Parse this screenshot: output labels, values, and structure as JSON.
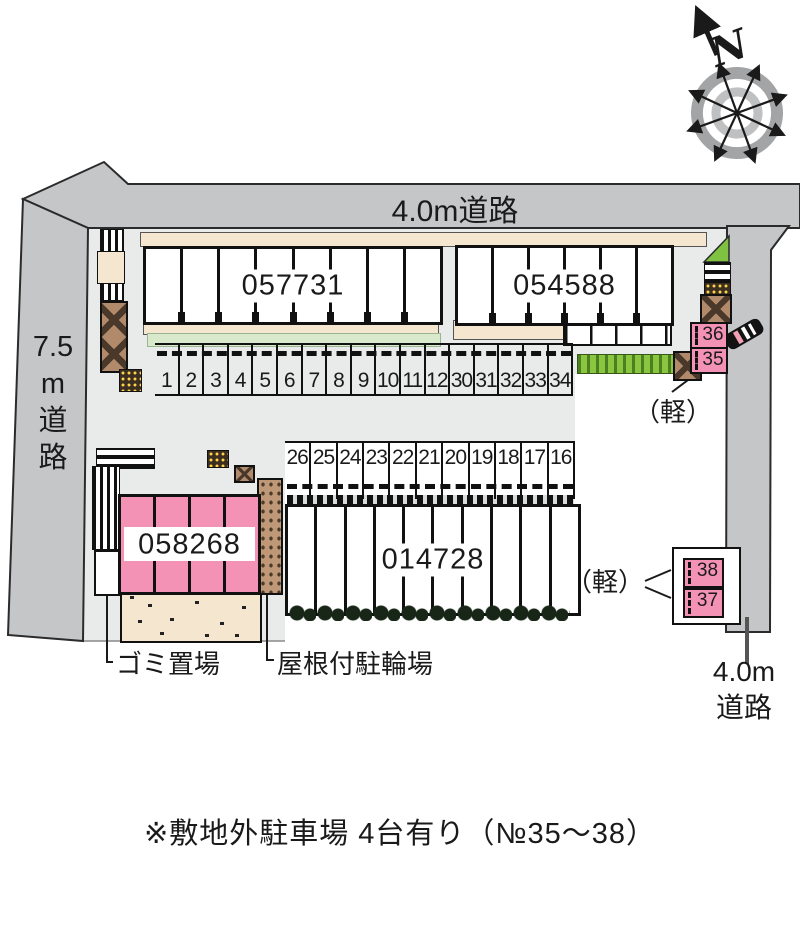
{
  "roads": {
    "top": {
      "label": "4.0m道路"
    },
    "left": {
      "lines": [
        "7.5",
        "m",
        "道",
        "路"
      ]
    },
    "right": {
      "lines": [
        "4.0m",
        "道路"
      ]
    }
  },
  "compass": {
    "north_label": "N"
  },
  "buildings": {
    "b1": {
      "id": "057731",
      "units": 8
    },
    "b2": {
      "id": "054588",
      "units": 6
    },
    "b3": {
      "id": "058268",
      "units": 4
    },
    "b4": {
      "id": "014728",
      "units": 10
    }
  },
  "parking": {
    "row1": [
      "1",
      "2",
      "3",
      "4",
      "5",
      "6",
      "7",
      "8",
      "9",
      "10",
      "11",
      "12",
      "30",
      "31",
      "32",
      "33",
      "34"
    ],
    "row2": [
      "26",
      "25",
      "24",
      "23",
      "22",
      "21",
      "20",
      "19",
      "18",
      "17",
      "16"
    ],
    "kei_label": "（軽）",
    "offsite_upper": [
      "36",
      "35"
    ],
    "offsite_lower": [
      "38",
      "37"
    ]
  },
  "annotations": {
    "garbage": "ゴミ置場",
    "bicycle": "屋根付駐輪場",
    "footnote": "※敷地外駐車場 4台有り（№35～38）"
  },
  "colors": {
    "road": "#c5c6c8",
    "plot": "#e9eaea",
    "pink": "#f492b6",
    "beige": "#f5e7cf",
    "hedge": "#8cc63e",
    "light_green": "#d9e9cc",
    "brown": "#bf9878"
  }
}
